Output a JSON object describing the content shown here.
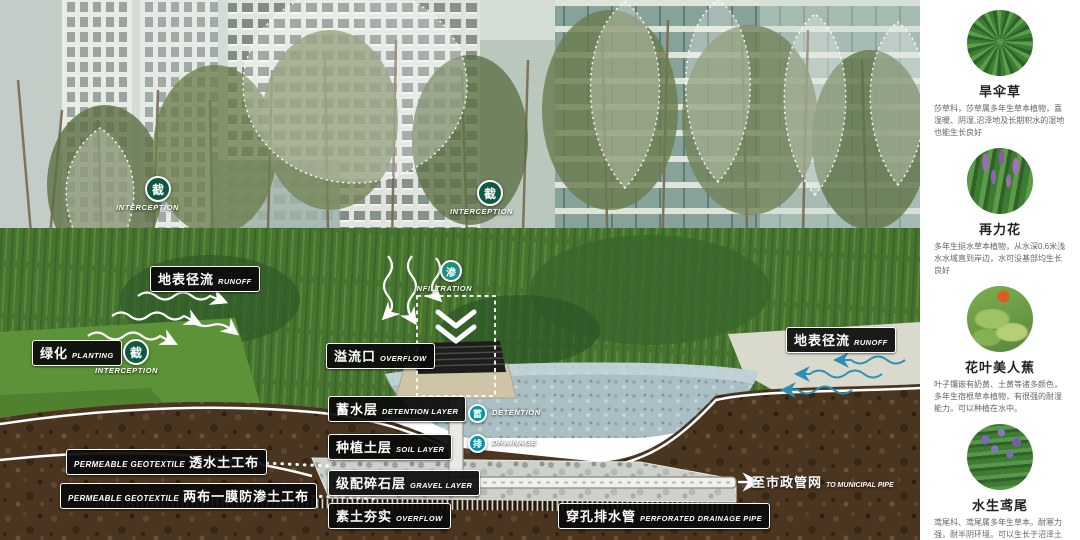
{
  "diagram": {
    "labels": {
      "runoff_left": {
        "zh": "地表径流",
        "en": "RUNOFF"
      },
      "runoff_right": {
        "zh": "地表径流",
        "en": "RUNOFF"
      },
      "planting": {
        "zh": "绿化",
        "en": "PLANTING"
      },
      "overflow_inlet": {
        "zh": "溢流口",
        "en": "OVERFLOW"
      },
      "detention_layer": {
        "zh": "蓄水层",
        "en": "DETENTION LAYER"
      },
      "soil_layer": {
        "zh": "种植土层",
        "en": "SOIL LAYER"
      },
      "gravel_layer": {
        "zh": "级配碎石层",
        "en": "GRAVEL LAYER"
      },
      "compacted_soil": {
        "zh": "素土夯实",
        "en": "OVERFLOW"
      },
      "perforated_pipe": {
        "zh": "穿孔排水管",
        "en": "PERFORATED DRAINAGE PIPE"
      },
      "geotextile_permeable": {
        "en": "PERMEABLE GEOTEXTILE",
        "zh": "透水土工布"
      },
      "geotextile_membrane": {
        "en": "PERMEABLE GEOTEXTILE",
        "zh": "两布一膜防渗土工布"
      },
      "to_municipal": {
        "arrow": "→",
        "zh": "至市政管网",
        "en": "TO MUNICIPAL PIPE"
      }
    },
    "icons": {
      "interception": {
        "char": "截",
        "en": "INTERCEPTION",
        "color": "#0e5a41"
      },
      "infiltration": {
        "char": "渗",
        "en": "INFILTRATION",
        "color": "#1d8f7e"
      },
      "detention": {
        "char": "蓄",
        "en": "DETENTION",
        "color": "#0297a5"
      },
      "drainage": {
        "char": "排",
        "en": "DRAINAGE",
        "color": "#0297a5"
      }
    }
  },
  "sidebar": {
    "plants": [
      {
        "name": "旱伞草",
        "desc": "莎草科，莎草属多年生草本植物，喜湿暖、阴湿,沼泽地及长期积水的湿地也能生长良好"
      },
      {
        "name": "再力花",
        "desc": "多年生挺水草本植物，从水深0.6米浅水水域直到岸边，水可没基部均生长良好"
      },
      {
        "name": "花叶美人蕉",
        "desc": "叶子镶嵌有奶黄、土黄等诸多颜色，多年生宿根草本植物，有很强的耐湿能力。可以种植在水中。"
      },
      {
        "name": "水生鸢尾",
        "desc": "鸢尾科、鸢尾属多年生草本。耐寒力强，耐半阴环境。可以生长于沼泽土壤或浅水层中。"
      }
    ]
  }
}
